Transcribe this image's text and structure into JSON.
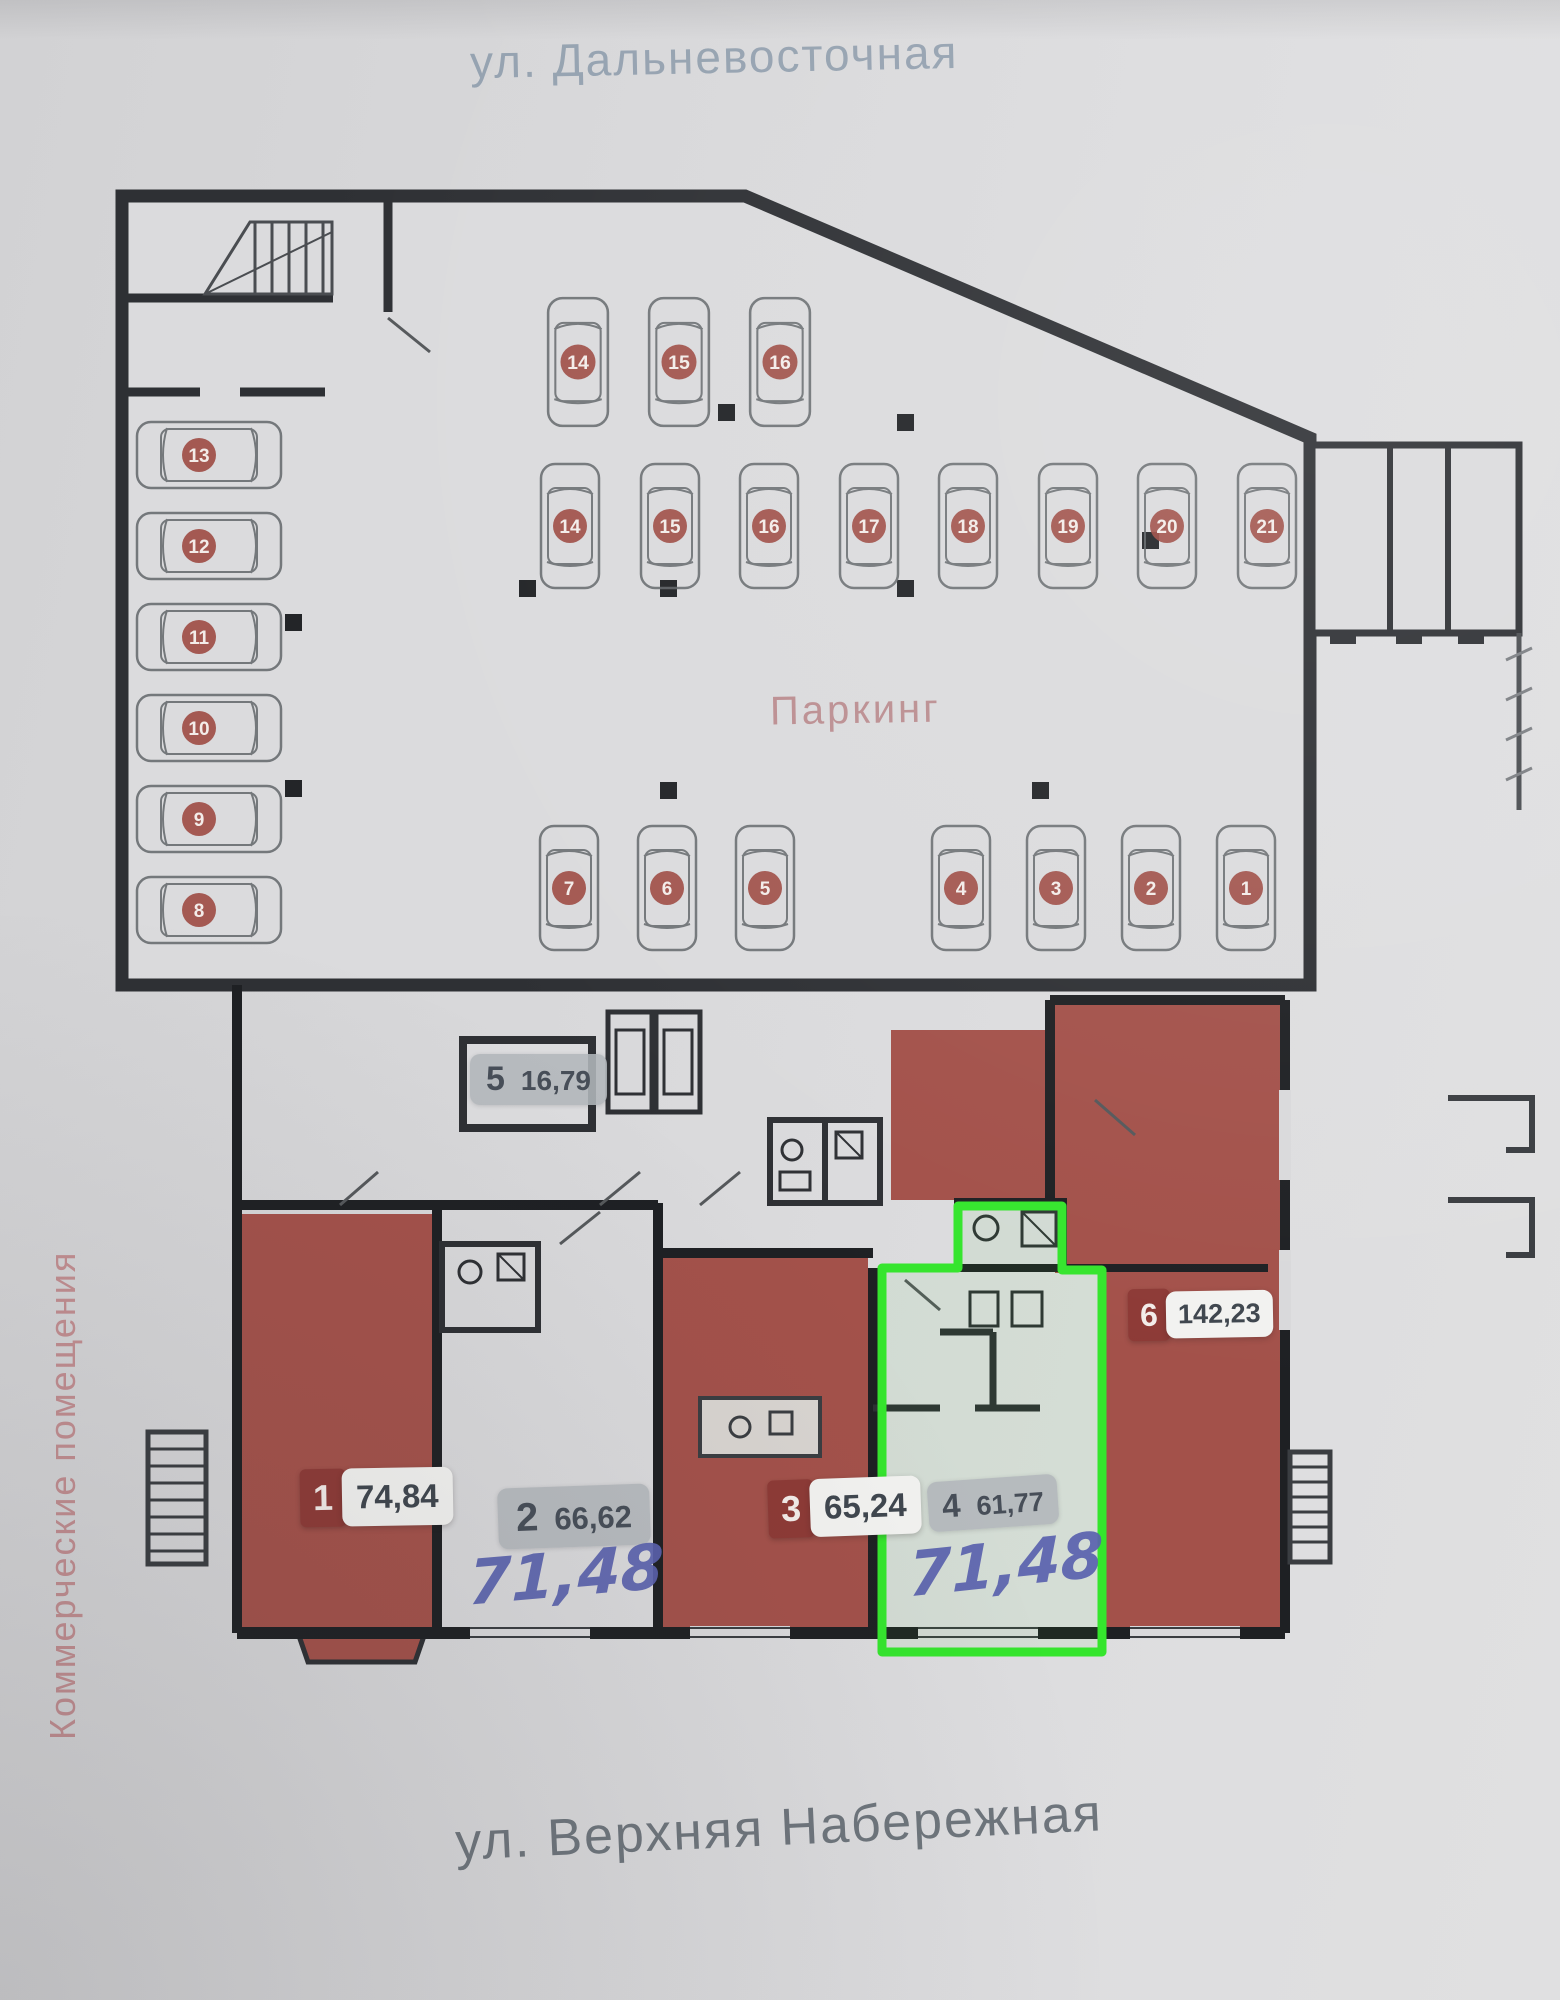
{
  "streets": {
    "top": "ул. Дальневосточная",
    "bottom": "ул. Верхняя Набережная"
  },
  "labels": {
    "parking": "Паркинг",
    "commercial_premises": "Коммерческие помещения"
  },
  "units": [
    {
      "number": "1",
      "area": "74,84",
      "style": "red"
    },
    {
      "number": "2",
      "area": "66,62",
      "style": "gray",
      "handwritten_area": "71,48"
    },
    {
      "number": "3",
      "area": "65,24",
      "style": "red"
    },
    {
      "number": "4",
      "area": "61,77",
      "style": "gray",
      "handwritten_area": "71,48",
      "highlighted": true
    },
    {
      "number": "5",
      "area": "16,79",
      "style": "gray"
    },
    {
      "number": "6",
      "area": "142,23",
      "style": "red"
    }
  ],
  "parking_spots": {
    "left_column": [
      "13",
      "12",
      "11",
      "10",
      "9",
      "8"
    ],
    "top_row": [
      "14",
      "15",
      "16"
    ],
    "middle_row": [
      "14",
      "15",
      "16",
      "17",
      "18",
      "19",
      "20",
      "21"
    ],
    "bottom_row_left": [
      "7",
      "6",
      "5"
    ],
    "bottom_row_right": [
      "4",
      "3",
      "2",
      "1"
    ]
  },
  "colors": {
    "paper": "#d9d9db",
    "wall": "#2e3034",
    "room_red": "#a3514a",
    "spot_badge_red": "#9d4a43",
    "unit_badge_red": "#8d3a36",
    "unit_badge_gray": "#b4b8bd",
    "area_text": "#474e58",
    "handwriting_blue": "#5a62ae",
    "highlight_green": "#35e52d",
    "street_text_top": "#95a2b0",
    "street_text_bottom": "#6e757c",
    "rose_label": "#bb8e91",
    "car_outline": "#63676b"
  }
}
